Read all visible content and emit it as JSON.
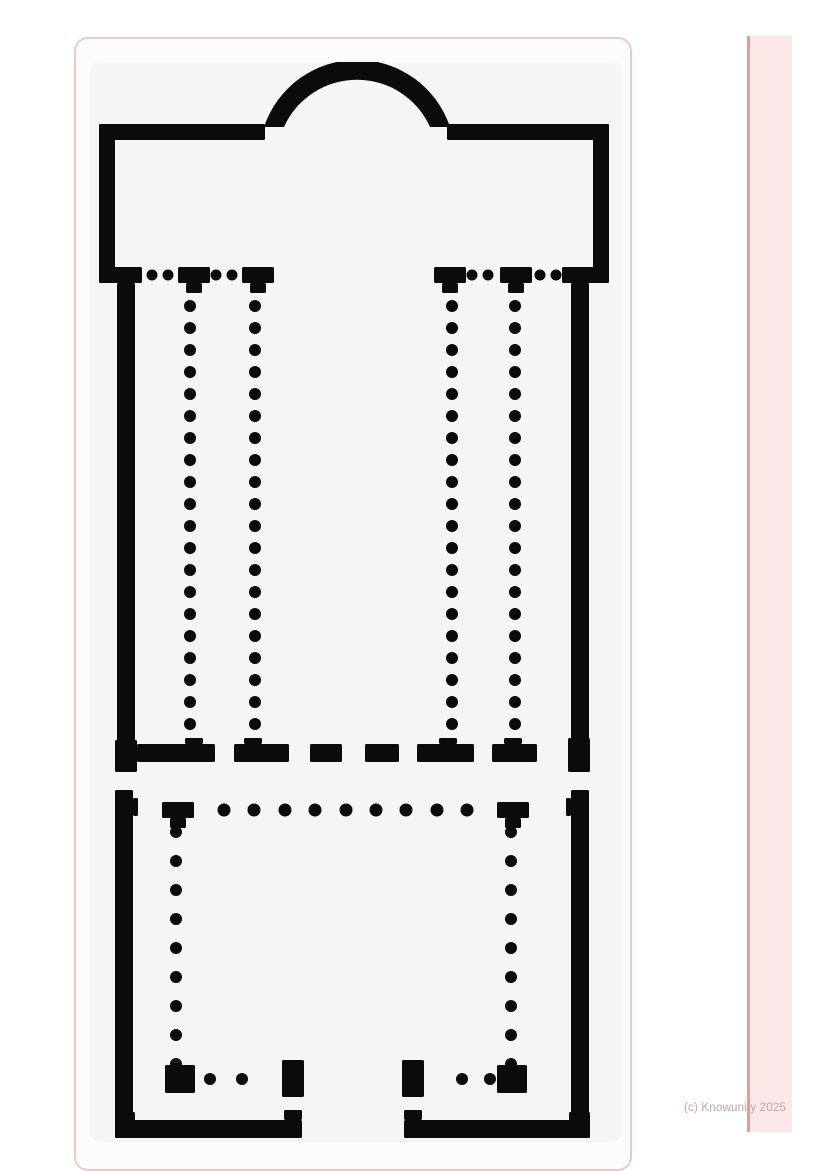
{
  "watermark": {
    "text": "(c) Knowunity 2025"
  },
  "colors": {
    "page_background": "#ffffff",
    "card_border": "#edc9c9",
    "card_background": "#fdfcfc",
    "plan_background": "#f5f5f6",
    "plan_ink": "#0b0b0b",
    "strip_fill": "#fce8e9",
    "strip_edge": "#e39d9d",
    "watermark_color": "#c1a4a4"
  },
  "plan": {
    "description": "basilica-floor-plan",
    "viewbox": "0 0 532 1080",
    "ink": "#0b0b0b",
    "walls": [
      [
        9,
        62,
        166,
        16
      ],
      [
        357,
        62,
        162,
        16
      ],
      [
        9,
        62,
        16,
        159
      ],
      [
        503,
        62,
        16,
        159
      ],
      [
        9,
        205,
        43,
        16
      ],
      [
        88,
        205,
        32,
        16
      ],
      [
        96,
        221,
        16,
        10
      ],
      [
        152,
        205,
        32,
        16
      ],
      [
        160,
        221,
        16,
        10
      ],
      [
        344,
        205,
        32,
        16
      ],
      [
        352,
        221,
        16,
        10
      ],
      [
        410,
        205,
        32,
        16
      ],
      [
        418,
        221,
        16,
        10
      ],
      [
        472,
        205,
        47,
        16
      ],
      [
        27,
        221,
        18,
        487
      ],
      [
        481,
        221,
        18,
        487
      ],
      [
        25,
        678,
        22,
        32
      ],
      [
        47,
        682,
        78,
        18
      ],
      [
        95,
        676,
        18,
        6
      ],
      [
        144,
        682,
        55,
        18
      ],
      [
        154,
        676,
        18,
        6
      ],
      [
        220,
        682,
        32,
        18
      ],
      [
        275,
        682,
        34,
        18
      ],
      [
        327,
        682,
        57,
        18
      ],
      [
        349,
        676,
        18,
        6
      ],
      [
        402,
        682,
        45,
        18
      ],
      [
        414,
        676,
        18,
        6
      ],
      [
        478,
        676,
        22,
        34
      ],
      [
        25,
        728,
        18,
        348
      ],
      [
        481,
        728,
        18,
        348
      ],
      [
        43,
        736,
        5,
        18
      ],
      [
        476,
        736,
        5,
        18
      ],
      [
        72,
        740,
        32,
        16
      ],
      [
        80,
        756,
        16,
        10
      ],
      [
        407,
        740,
        32,
        16
      ],
      [
        415,
        756,
        16,
        10
      ],
      [
        75,
        1003,
        30,
        28
      ],
      [
        407,
        1003,
        30,
        28
      ],
      [
        192,
        998,
        22,
        37
      ],
      [
        312,
        998,
        22,
        37
      ],
      [
        25,
        1058,
        187,
        18
      ],
      [
        314,
        1058,
        186,
        18
      ],
      [
        194,
        1048,
        18,
        10
      ],
      [
        314,
        1048,
        18,
        10
      ],
      [
        25,
        1050,
        20,
        26
      ],
      [
        479,
        1050,
        21,
        26
      ]
    ],
    "arcs": [
      "M174,65 A98 98 0 0 1 360,65 L340,65 A80 80 0 0 0 194,65 Z"
    ],
    "dot_columns": [
      {
        "cx": 100,
        "y_start": 244,
        "step": 22,
        "count": 20,
        "r": 6
      },
      {
        "cx": 165,
        "y_start": 244,
        "step": 22,
        "count": 20,
        "r": 6
      },
      {
        "cx": 362,
        "y_start": 244,
        "step": 22,
        "count": 20,
        "r": 6
      },
      {
        "cx": 425,
        "y_start": 244,
        "step": 22,
        "count": 20,
        "r": 6
      },
      {
        "cx": 86,
        "y_start": 770,
        "step": 29,
        "count": 9,
        "r": 6
      },
      {
        "cx": 421,
        "y_start": 770,
        "step": 29,
        "count": 9,
        "r": 6
      }
    ],
    "dot_rows": [
      {
        "cy": 213,
        "r": 5.5,
        "x": [
          62,
          78,
          126,
          142,
          382,
          398,
          450,
          466
        ]
      },
      {
        "cy": 748,
        "r": 6.5,
        "x": [
          134,
          164,
          195,
          225,
          256,
          286,
          316,
          347,
          377
        ]
      },
      {
        "cy": 1017,
        "r": 6,
        "x": [
          120,
          152,
          372,
          400
        ]
      }
    ]
  }
}
